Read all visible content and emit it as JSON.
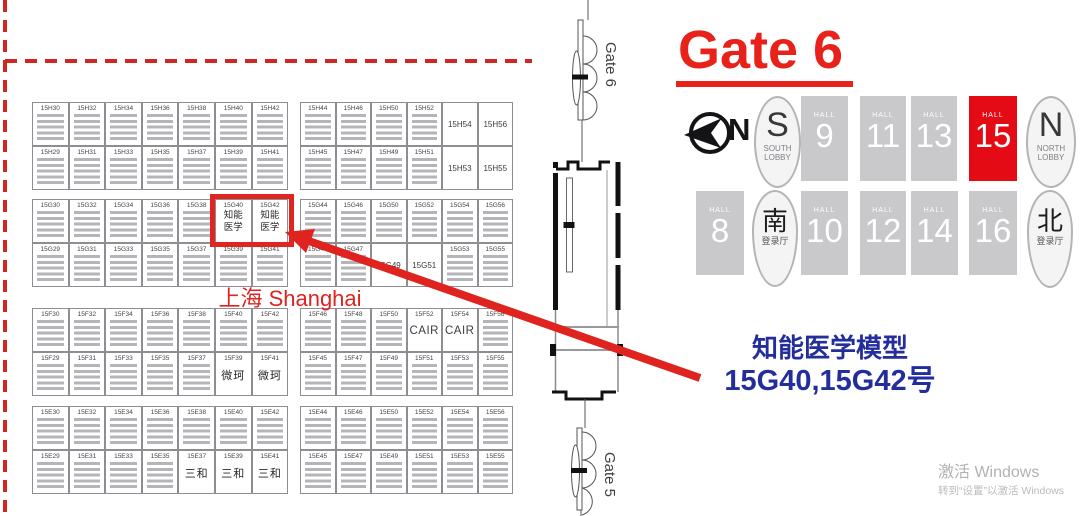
{
  "map": {
    "shanghai_label": "上海 Shanghai",
    "highlight_booths": [
      "15G40",
      "15G42"
    ],
    "bands": [
      {
        "key": "H",
        "left_top": [
          "15H30",
          "15H32",
          "15H34",
          "15H36",
          "15H38",
          "15H40",
          "15H42"
        ],
        "left_bottom": [
          "15H29",
          "15H31",
          "15H33",
          "15H35",
          "15H37",
          "15H39",
          "15H41"
        ],
        "right_top": [
          "15H44",
          "15H46",
          "15H50",
          "15H52",
          "15H54",
          "15H56"
        ],
        "right_bottom": [
          "15H45",
          "15H47",
          "15H49",
          "15H51",
          "15H53",
          "15H55"
        ]
      },
      {
        "key": "G",
        "left_top": [
          "15G30",
          "15G32",
          "15G34",
          "15G36",
          "15G38",
          "15G40",
          "15G42"
        ],
        "left_bottom": [
          "15G29",
          "15G31",
          "15G33",
          "15G35",
          "15G37",
          "15G39",
          "15G41"
        ],
        "right_top": [
          "15G44",
          "15G46",
          "15G50",
          "15G52",
          "15G54",
          "15G56"
        ],
        "right_bottom": [
          "15G45",
          "15G47",
          "15G49",
          "15G51",
          "15G53",
          "15G55"
        ]
      },
      {
        "key": "F",
        "left_top": [
          "15F30",
          "15F32",
          "15F34",
          "15F36",
          "15F38",
          "15F40",
          "15F42"
        ],
        "left_bottom": [
          "15F29",
          "15F31",
          "15F33",
          "15F35",
          "15F37",
          "15F39",
          "15F41"
        ],
        "right_top": [
          "15F46",
          "15F48",
          "15F50",
          "15F52",
          "15F54",
          "15F56"
        ],
        "right_bottom": [
          "15F45",
          "15F47",
          "15F49",
          "15F51",
          "15F53",
          "15F55"
        ]
      },
      {
        "key": "E",
        "left_top": [
          "15E30",
          "15E32",
          "15E34",
          "15E36",
          "15E38",
          "15E40",
          "15E42"
        ],
        "left_bottom": [
          "15E29",
          "15E31",
          "15E33",
          "15E35",
          "15E37",
          "15E39",
          "15E41"
        ],
        "right_top": [
          "15E44",
          "15E46",
          "15E50",
          "15E52",
          "15E54",
          "15E56"
        ],
        "right_bottom": [
          "15E45",
          "15E47",
          "15E49",
          "15E51",
          "15E53",
          "15E55"
        ]
      }
    ],
    "special_cells": {
      "15G40": {
        "label": "知能医学",
        "highlight": true
      },
      "15G42": {
        "label": "知能医学",
        "highlight": true
      },
      "15F39": {
        "label": "微珂"
      },
      "15F41": {
        "label": "微珂"
      },
      "15F52": {
        "label": "CAIR",
        "big": true
      },
      "15F54": {
        "label": "CAIR",
        "big": true
      },
      "15E37": {
        "label": "三和"
      },
      "15E39": {
        "label": "三和"
      },
      "15E41": {
        "label": "三和"
      },
      "15H53": {
        "plain": true
      },
      "15H54": {
        "plain": true
      },
      "15H55": {
        "plain": true
      },
      "15H56": {
        "plain": true
      },
      "15G49": {
        "plain": true
      },
      "15G51": {
        "plain": true
      }
    }
  },
  "corridor": {
    "gate6_label": "Gate 6",
    "gate5_label": "Gate 5"
  },
  "right_panel": {
    "gate_title": "Gate 6",
    "compass_n": "N",
    "south_lobby_letter": "S",
    "south_lobby_text": "SOUTH LOBBY",
    "north_lobby_letter": "N",
    "north_lobby_text": "NORTH LOBBY",
    "south_reg_char": "南",
    "south_reg_text": "登录厅",
    "north_reg_char": "北",
    "north_reg_text": "登录厅",
    "hall_word": "HALL",
    "halls_top": [
      "9",
      "11",
      "13",
      "15"
    ],
    "halls_bottom": [
      "8",
      "10",
      "12",
      "14",
      "16"
    ],
    "highlighted_hall": "15",
    "annotation_line1": "知能医学模型",
    "annotation_line2": "15G40,15G42号"
  },
  "watermark": {
    "line1": "激活 Windows",
    "line2": "转到“设置”以激活 Windows"
  },
  "colors": {
    "accent_red": "#e0241f",
    "hall_gray": "#c9c9cc",
    "hall_highlight_red": "#e50b15",
    "annotation_blue": "#232d9c"
  }
}
